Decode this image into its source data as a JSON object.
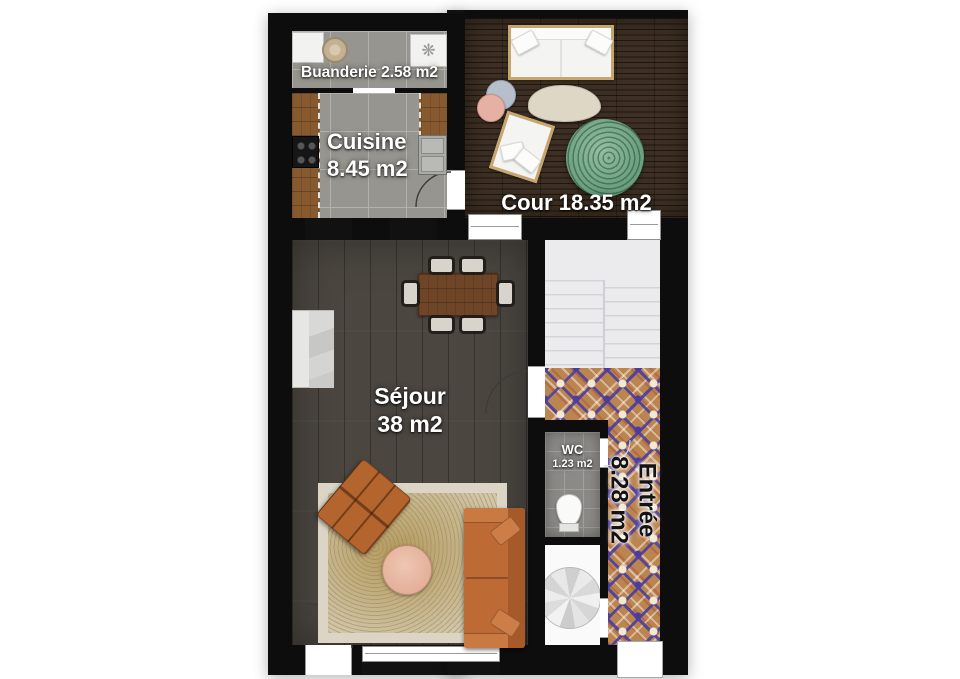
{
  "plan": {
    "type": "apartment-floor-plan",
    "rooms": {
      "buanderie": {
        "label": "Buanderie 2.58 m2"
      },
      "cuisine": {
        "name": "Cuisine",
        "area": "8.45 m2"
      },
      "cour": {
        "label": "Cour 18.35 m2"
      },
      "sejour": {
        "name": "Séjour",
        "area": "38 m2"
      },
      "wc": {
        "name": "WC",
        "area": "1.23 m2"
      },
      "entree": {
        "name": "Entrée",
        "area": "8.28 m2"
      }
    },
    "icons": {
      "hvac_glyph": "❋"
    },
    "colors": {
      "wall": "#0d0d0d",
      "deck_wood": "#3d2f23",
      "sejour_floor": "#4b4640",
      "kitchen_tile": "#97958f",
      "entree_tile_base": "#bb8550",
      "entree_tile_accent": "#4a3d9e",
      "stairs": "#ebebed",
      "counter_wood": "#86592f",
      "sofa_orange": "#bf6c36",
      "rug_beige": "#d0c7ae",
      "table_pink": "#e5b29e",
      "tree_green": "#76a886"
    }
  }
}
